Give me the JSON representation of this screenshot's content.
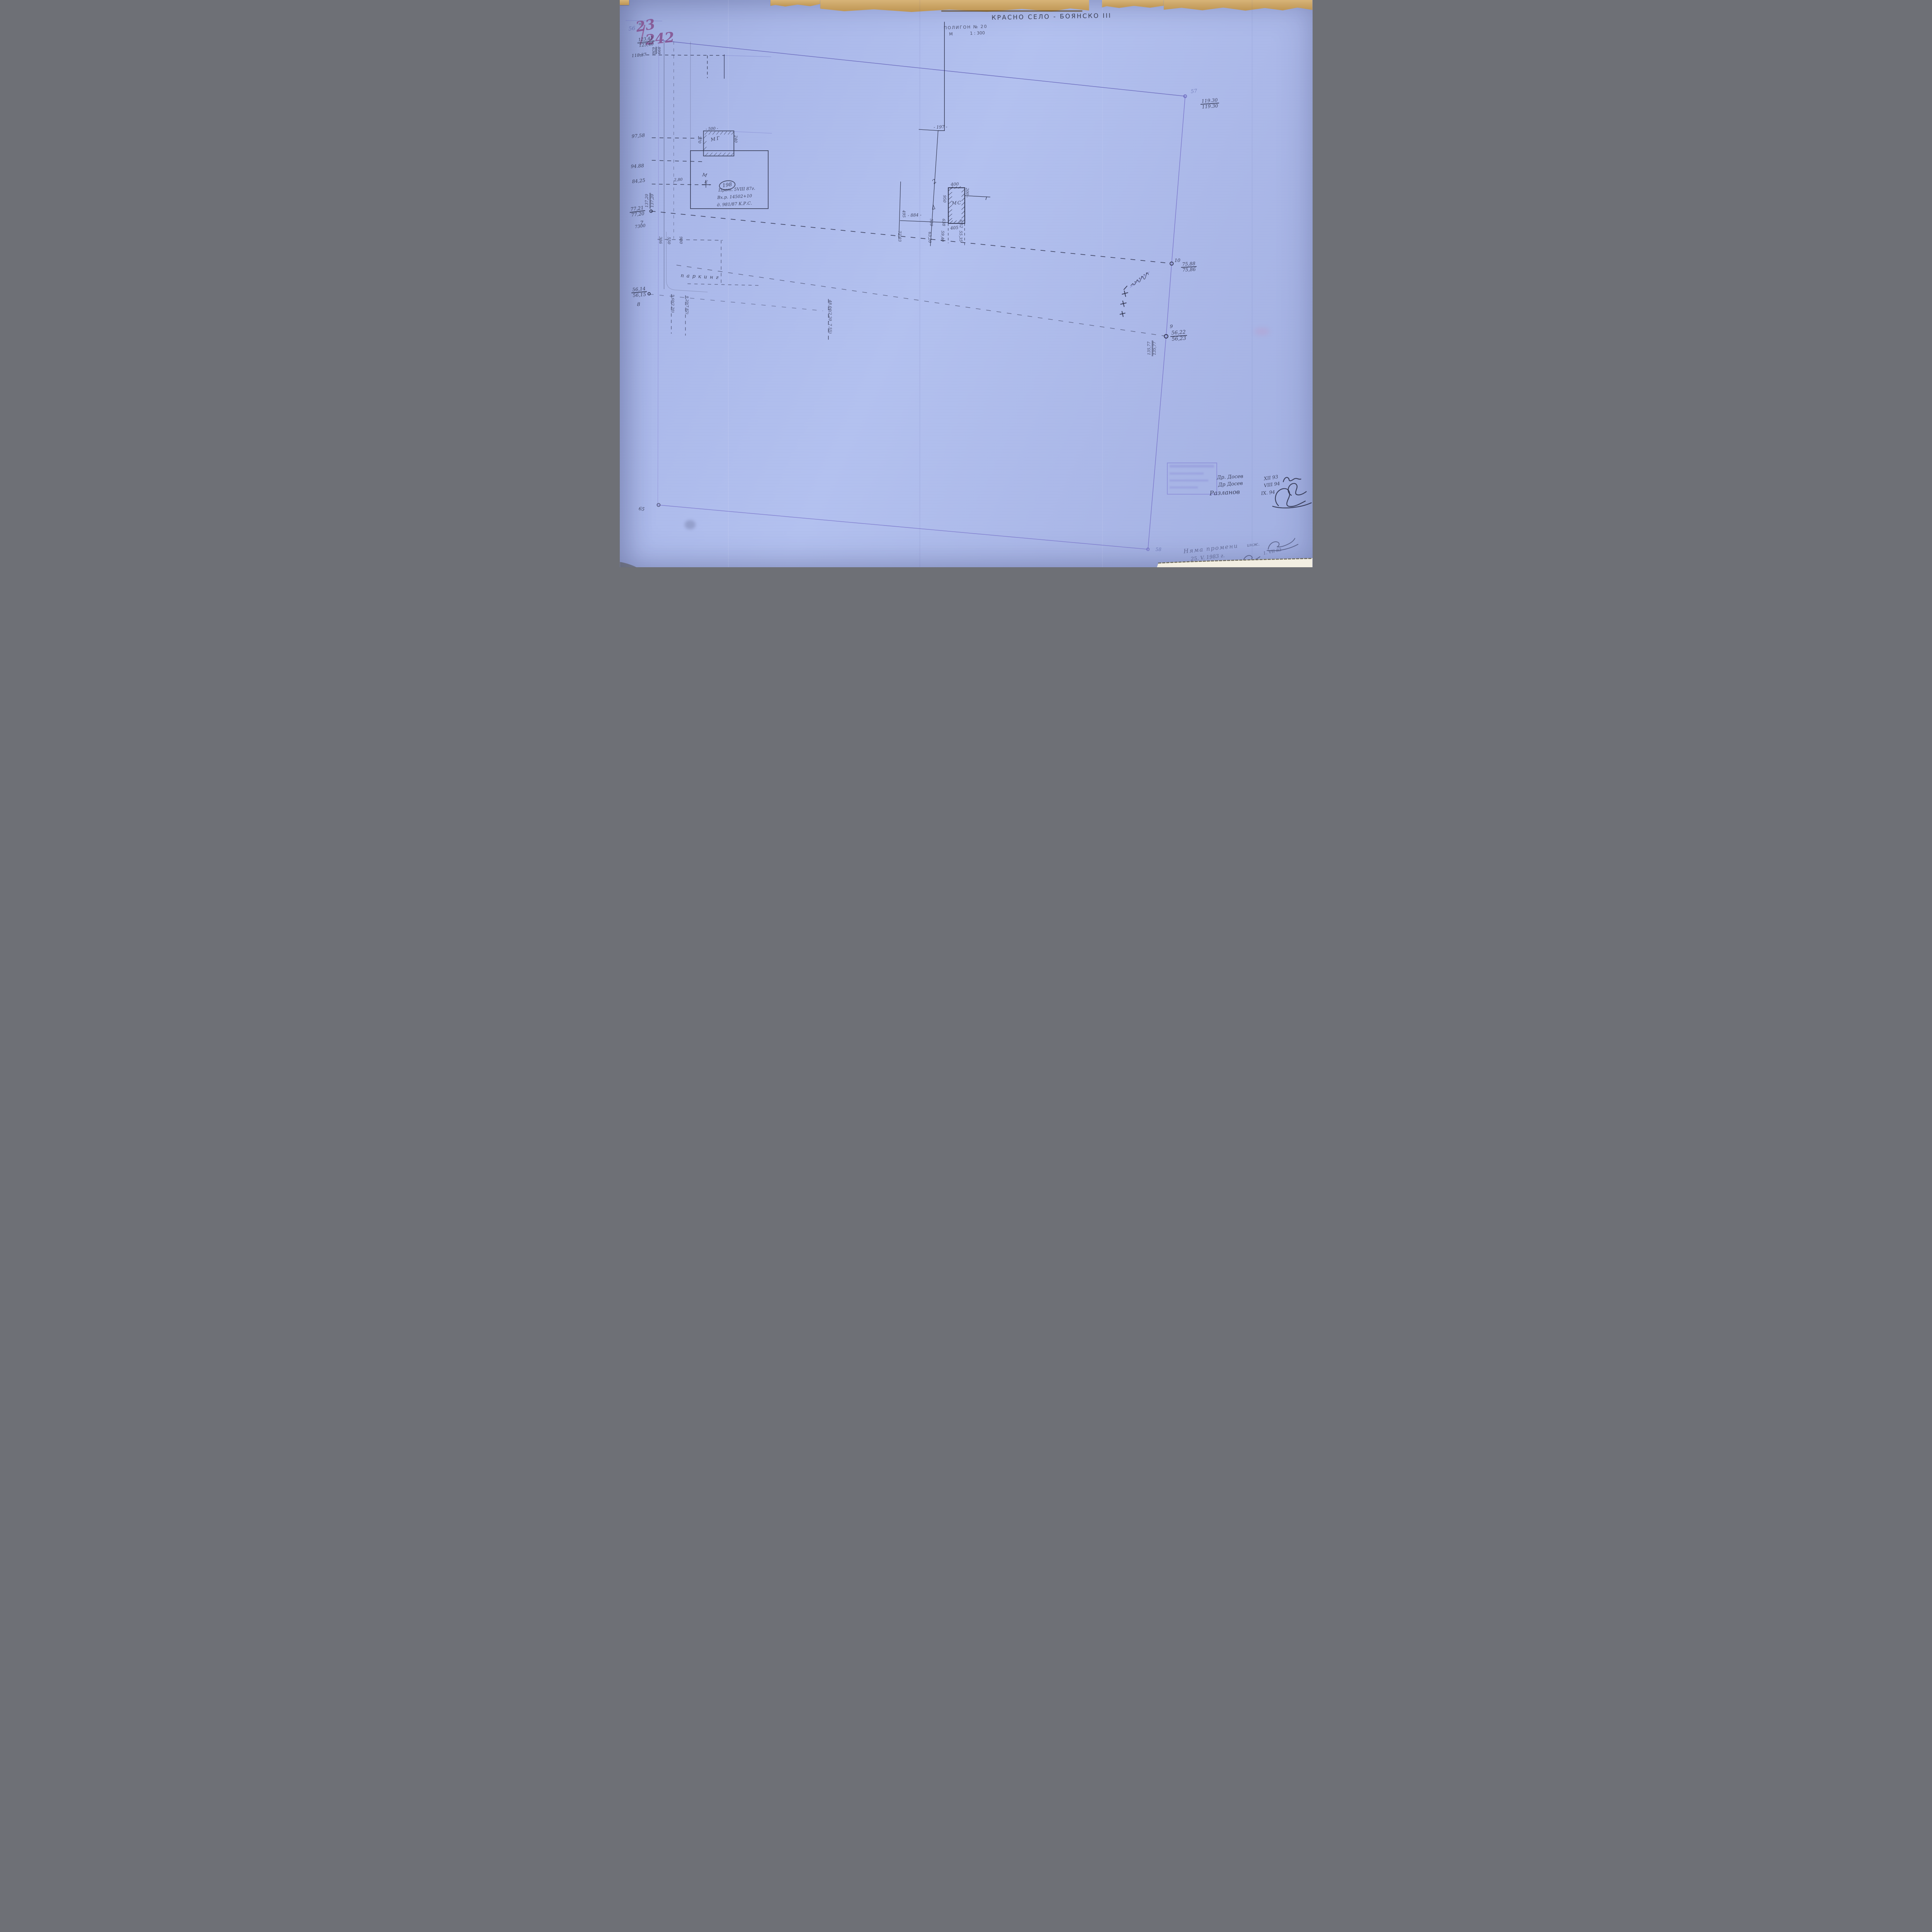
{
  "meta": {
    "district_title": "КРАСНО СЕЛО - БОЯНСКО III",
    "polygon_label": "ПОЛИГОН № 20",
    "scale_letter": "М",
    "scale_value": "1 : 300",
    "sheet_faint": "56",
    "parcel_big_top": "23",
    "parcel_big_bottom": "242"
  },
  "nw": {
    "elev_top": "123,42",
    "elev_bottom": "123,40",
    "dist": "118,37",
    "off_a": "636",
    "off_b": "899"
  },
  "west": {
    "v1": "97,58",
    "v2": "94.88",
    "v3": "84,25",
    "v3b": "2,80",
    "mark_m": "М",
    "mark_e": "Е",
    "dbl_top": "137,20",
    "dbl_bottom": "137,20",
    "p7_top": "77,21",
    "p7_bottom": "77,20",
    "p7": "7",
    "p7_dist": "7300",
    "p8_top": "56,14",
    "p8_bottom": "56,15",
    "p8": "8"
  },
  "offsets": {
    "o1": "336",
    "o2": "550",
    "o3": "980",
    "o4": "5,60(2,20)",
    "o5": "9,20(7,82)",
    "o6": "48,04(2.20, 7.55)",
    "parking": "паркинг"
  },
  "building": {
    "no": "198",
    "note1": "Прот. 5VIII 87г.",
    "note2": "Вх.р. 14502+10",
    "note3": "д. 981/87 К.Р.С.",
    "garage": "МГ",
    "g_top": "- 500 -",
    "g_left": "270",
    "g_right": "240"
  },
  "ms": {
    "name": "МС",
    "top": "400",
    "right": "200 -",
    "left": "950",
    "bottom": "405",
    "d884": "- 884 -",
    "d197": "- 197 -",
    "bend": "2",
    "c1_off": "495",
    "c1_chain": "72,03",
    "c2_off": "520",
    "c2_chain": "63,20",
    "c3_off": "638",
    "c3_chain": "59,40",
    "c4_off": "6,52",
    "c4_chain": "55,35"
  },
  "pts": {
    "p57": "57",
    "p57_a": "119.30",
    "p57_b": "119.30",
    "p10": "10",
    "p10_a": "75,88",
    "p10_b": "75,86",
    "p9": "9",
    "p9_a": "56,22",
    "p9_b": "56,23",
    "p9_ra": "135,77",
    "p9_rb": "135,77",
    "p65": "65",
    "p58": "58"
  },
  "signoff": {
    "r1_name": "Др. Досев",
    "r1_date": "XII 93",
    "r2_name": "Др Досев",
    "r2_date": "VIII 94",
    "r3_name": "Разланов",
    "r3_date": "IX. 94"
  },
  "notes": {
    "l1": "Няма промени",
    "l2": "25. V. 1983 г.",
    "eng": "инж.",
    "d2": "1. VII 83"
  }
}
